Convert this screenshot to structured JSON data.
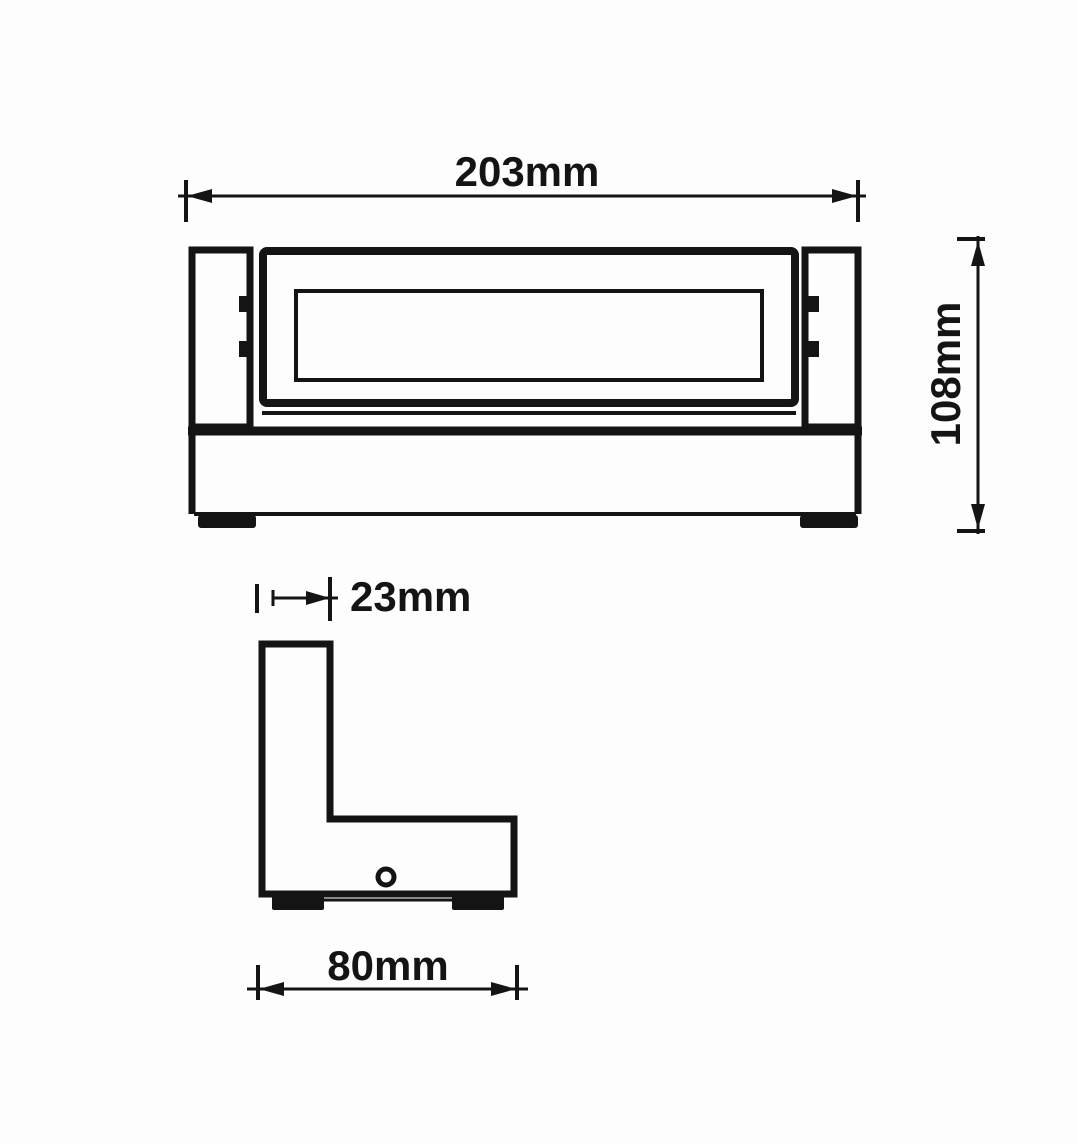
{
  "page": {
    "background": "#fdfdfd"
  },
  "drawing": {
    "type": "technical-dimension-drawing",
    "subject": "wall-light-fixture",
    "line_color": "#141414",
    "front_view": {
      "width_dim": "203mm",
      "height_dim": "108mm"
    },
    "side_view": {
      "arm_dim": "23mm",
      "depth_dim": "80mm"
    }
  }
}
